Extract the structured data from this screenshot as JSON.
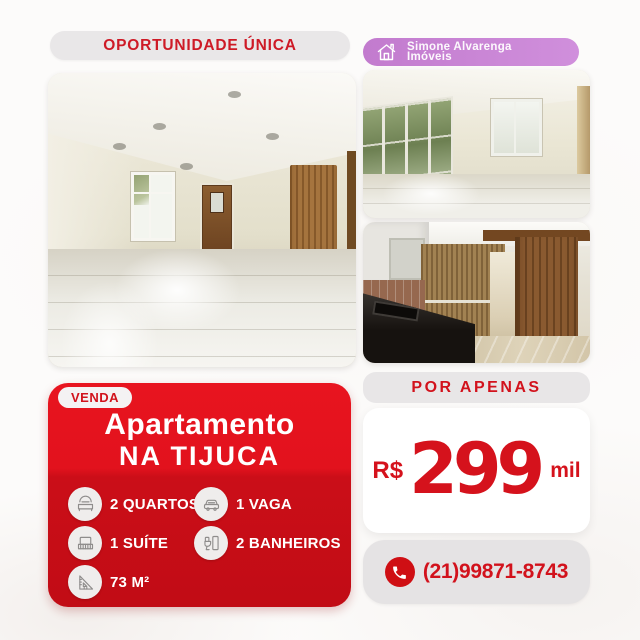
{
  "header": {
    "opportunity_badge": "OPORTUNIDADE ÚNICA",
    "brand": {
      "icon": "house-icon",
      "name_line1": "Simone Alvarenga",
      "name_line2": "Imóveis"
    }
  },
  "listing_card": {
    "sale_badge": "VENDA",
    "title_line1": "Apartamento",
    "title_line2": "NA TIJUCA",
    "features_left": [
      {
        "icon": "bed-icon",
        "label": "2 QUARTOS"
      },
      {
        "icon": "double-bed-icon",
        "label": "1 SUÍTE"
      },
      {
        "icon": "ruler-square-icon",
        "label": "73 M²"
      }
    ],
    "features_right": [
      {
        "icon": "car-icon",
        "label": "1 VAGA"
      },
      {
        "icon": "toilet-icon",
        "label": "2 BANHEIROS"
      }
    ]
  },
  "price_panel": {
    "label": "POR APENAS",
    "currency": "R$",
    "amount": "299",
    "suffix": "mil"
  },
  "contact": {
    "icon": "phone-icon",
    "phone_number": "(21)99871-8743"
  },
  "colors": {
    "accent_red": "#dd1120",
    "dark_red": "#c10c15",
    "brand_purple": "#c783d5",
    "pill_gray": "#e8e6e7"
  }
}
